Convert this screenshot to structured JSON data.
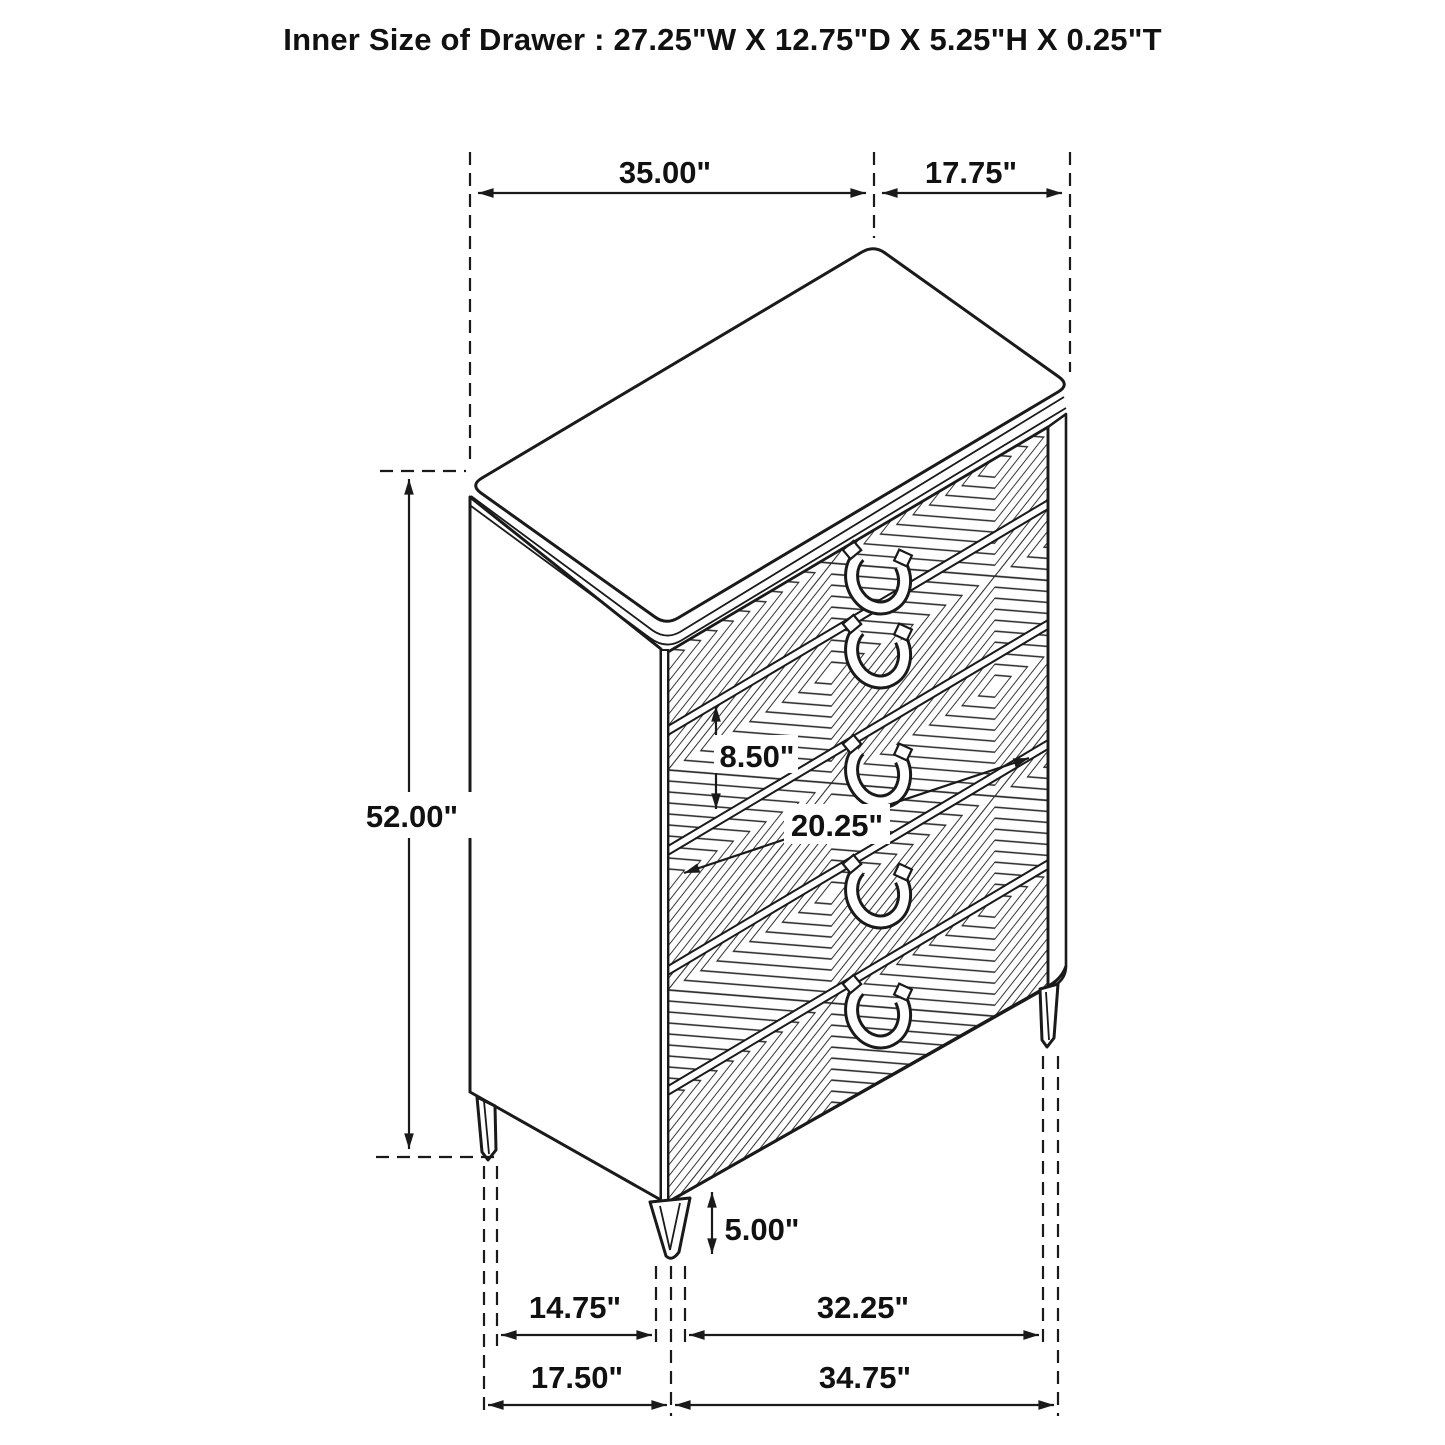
{
  "title": "Inner Size of Drawer : 27.25\"W X 12.75\"D X 5.25\"H X 0.25\"T",
  "dims": {
    "top_width": "35.00\"",
    "top_depth": "17.75\"",
    "overall_height": "52.00\"",
    "drawer_front_height": "8.50\"",
    "drawer_diagonal": "20.25\"",
    "leg_height": "5.00\"",
    "bottom_left_inner": "14.75\"",
    "bottom_right_inner": "32.25\"",
    "bottom_left_outer": "17.50\"",
    "bottom_right_outer": "34.75\""
  },
  "colors": {
    "line": "#1a1a1a",
    "background": "#ffffff"
  }
}
